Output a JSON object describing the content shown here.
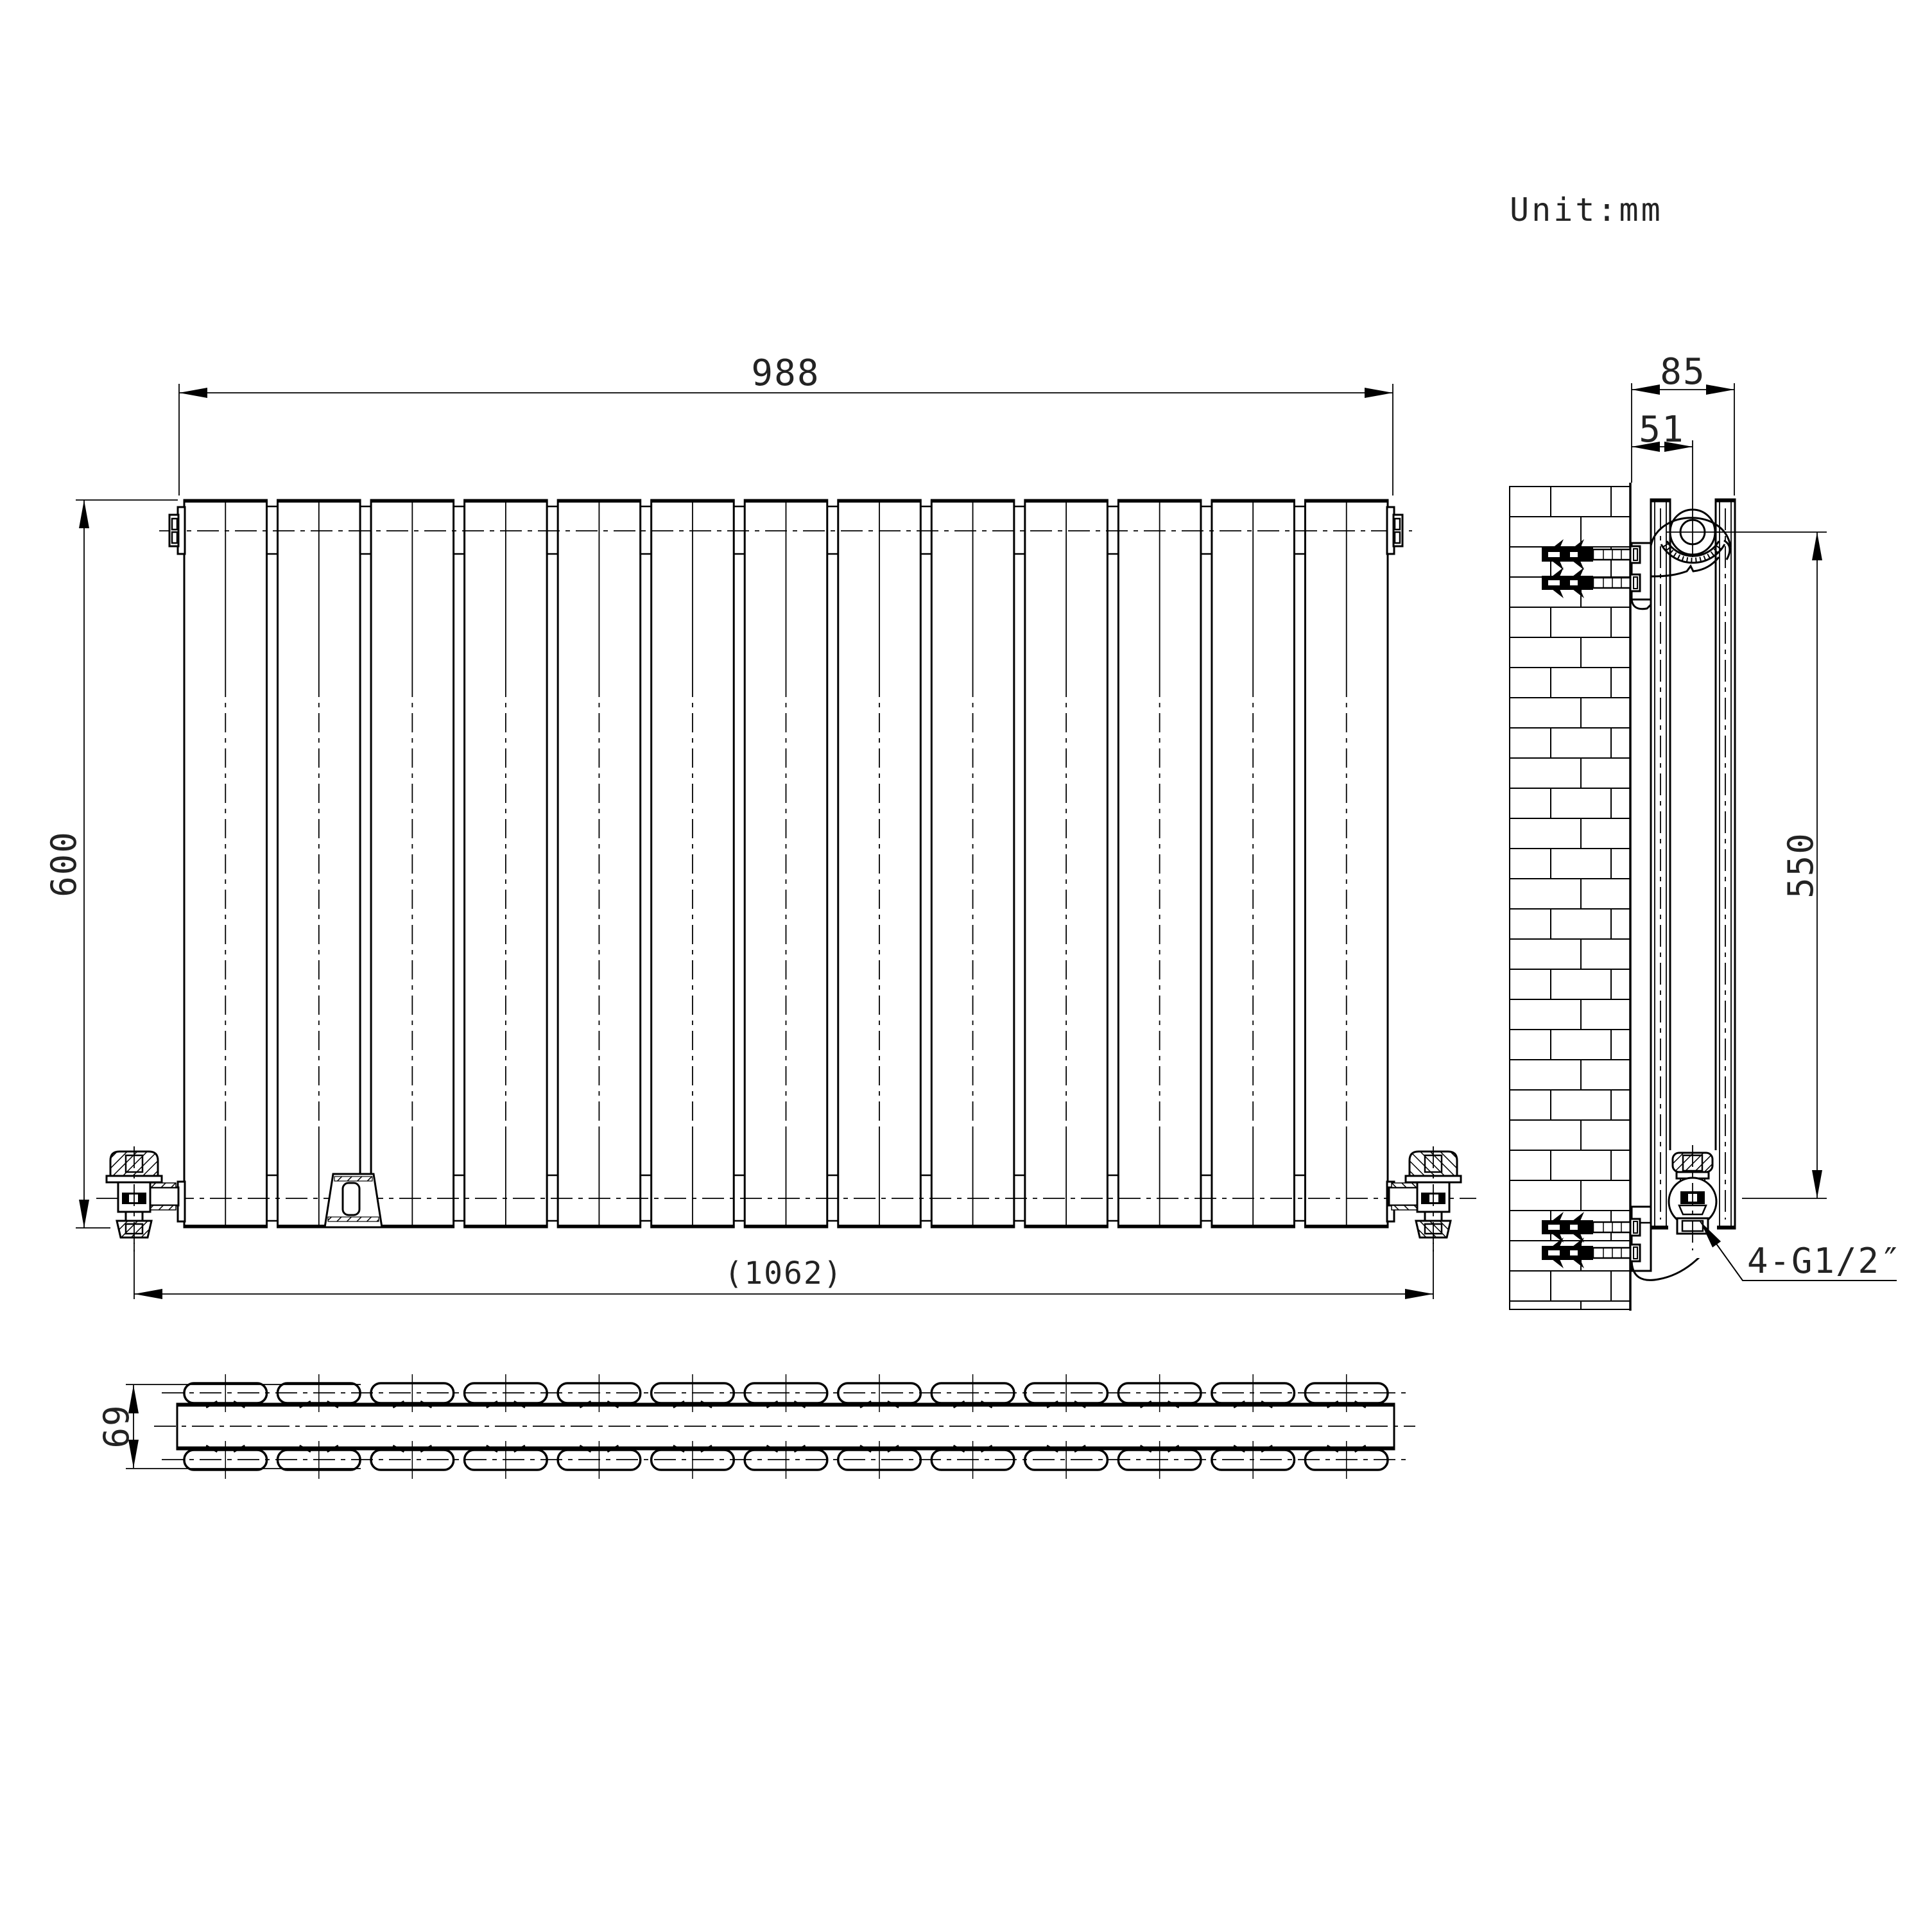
{
  "drawing": {
    "unit_label": "Unit:mm",
    "dims": {
      "width": "988",
      "height": "600",
      "overall_width": "(1062)",
      "depth_overall": "85",
      "wall_to_pipe": "51",
      "pipe_span": "550",
      "depth": "69",
      "thread_note": "4-G1/2″"
    },
    "front_view": {
      "panel_count": 13
    },
    "top_view": {
      "panel_count": 13
    },
    "side_view": {
      "anchor_count": 4
    }
  }
}
